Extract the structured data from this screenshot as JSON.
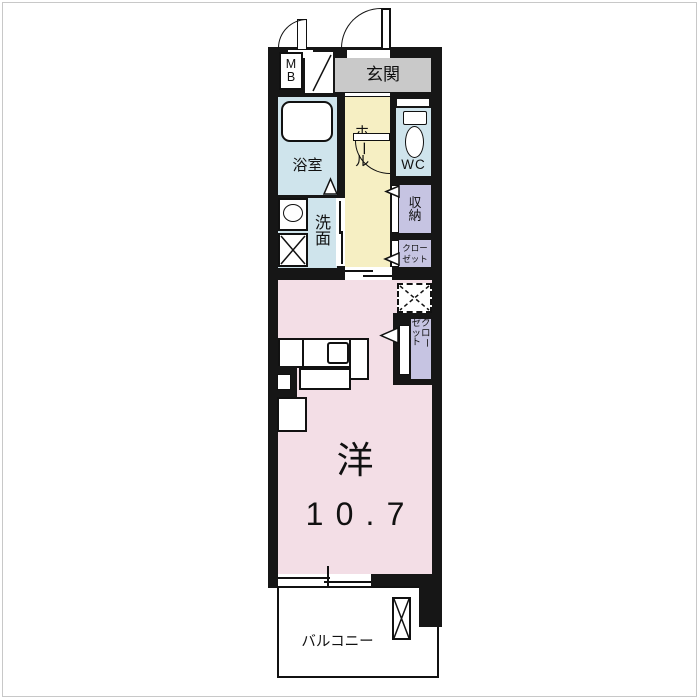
{
  "plan": {
    "labels": {
      "mb": "MB",
      "entrance": "玄関",
      "hall": "ホール",
      "bath": "浴室",
      "washroom": "洗面",
      "wc": "WC",
      "storage": "収納",
      "closet_upper_line1": "クロー",
      "closet_upper_line2": "ゼット",
      "closet_room_col1": "クロー",
      "closet_room_col2": "ゼット",
      "room_type": "洋",
      "room_size": "10.7",
      "balcony": "バルコニー"
    },
    "colors": {
      "wall": "#161616",
      "room_pink": "#f3dee6",
      "hall_yellow": "#f6efc3",
      "wet_area_blue": "#cfe4ec",
      "closet_lavender": "#c6c4e2",
      "entrance_gray": "#c9c9c9",
      "page_border_gray": "#c8c8c8"
    }
  }
}
